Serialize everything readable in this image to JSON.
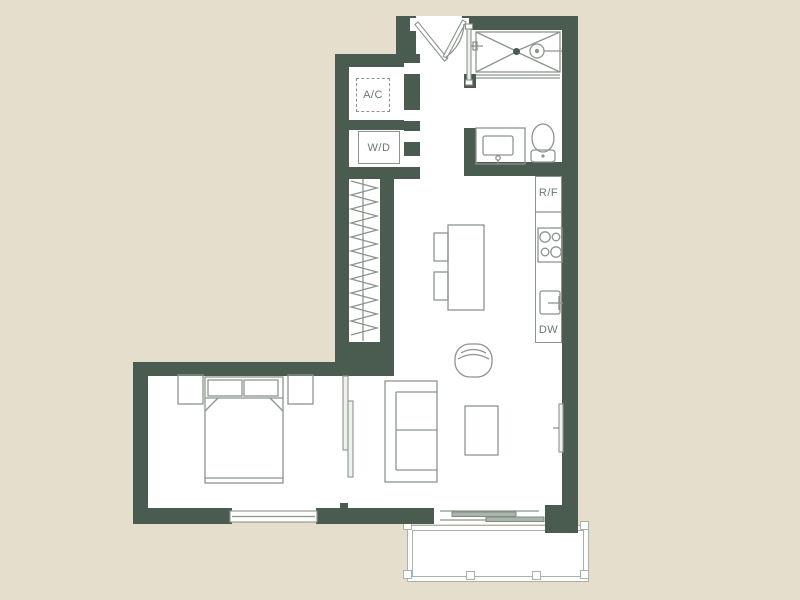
{
  "plan": {
    "labels": {
      "ac_closet": "A/C",
      "washer_dryer": "W/D",
      "refrigerator": "R/F",
      "dishwasher": "DW"
    },
    "colors": {
      "background": "#e5decd",
      "wall": "#4a5c50",
      "floor": "#ffffff",
      "fixture_line": "#8b958d",
      "balcony_line": "#a9b2a9",
      "label_text": "#6a796f"
    }
  }
}
